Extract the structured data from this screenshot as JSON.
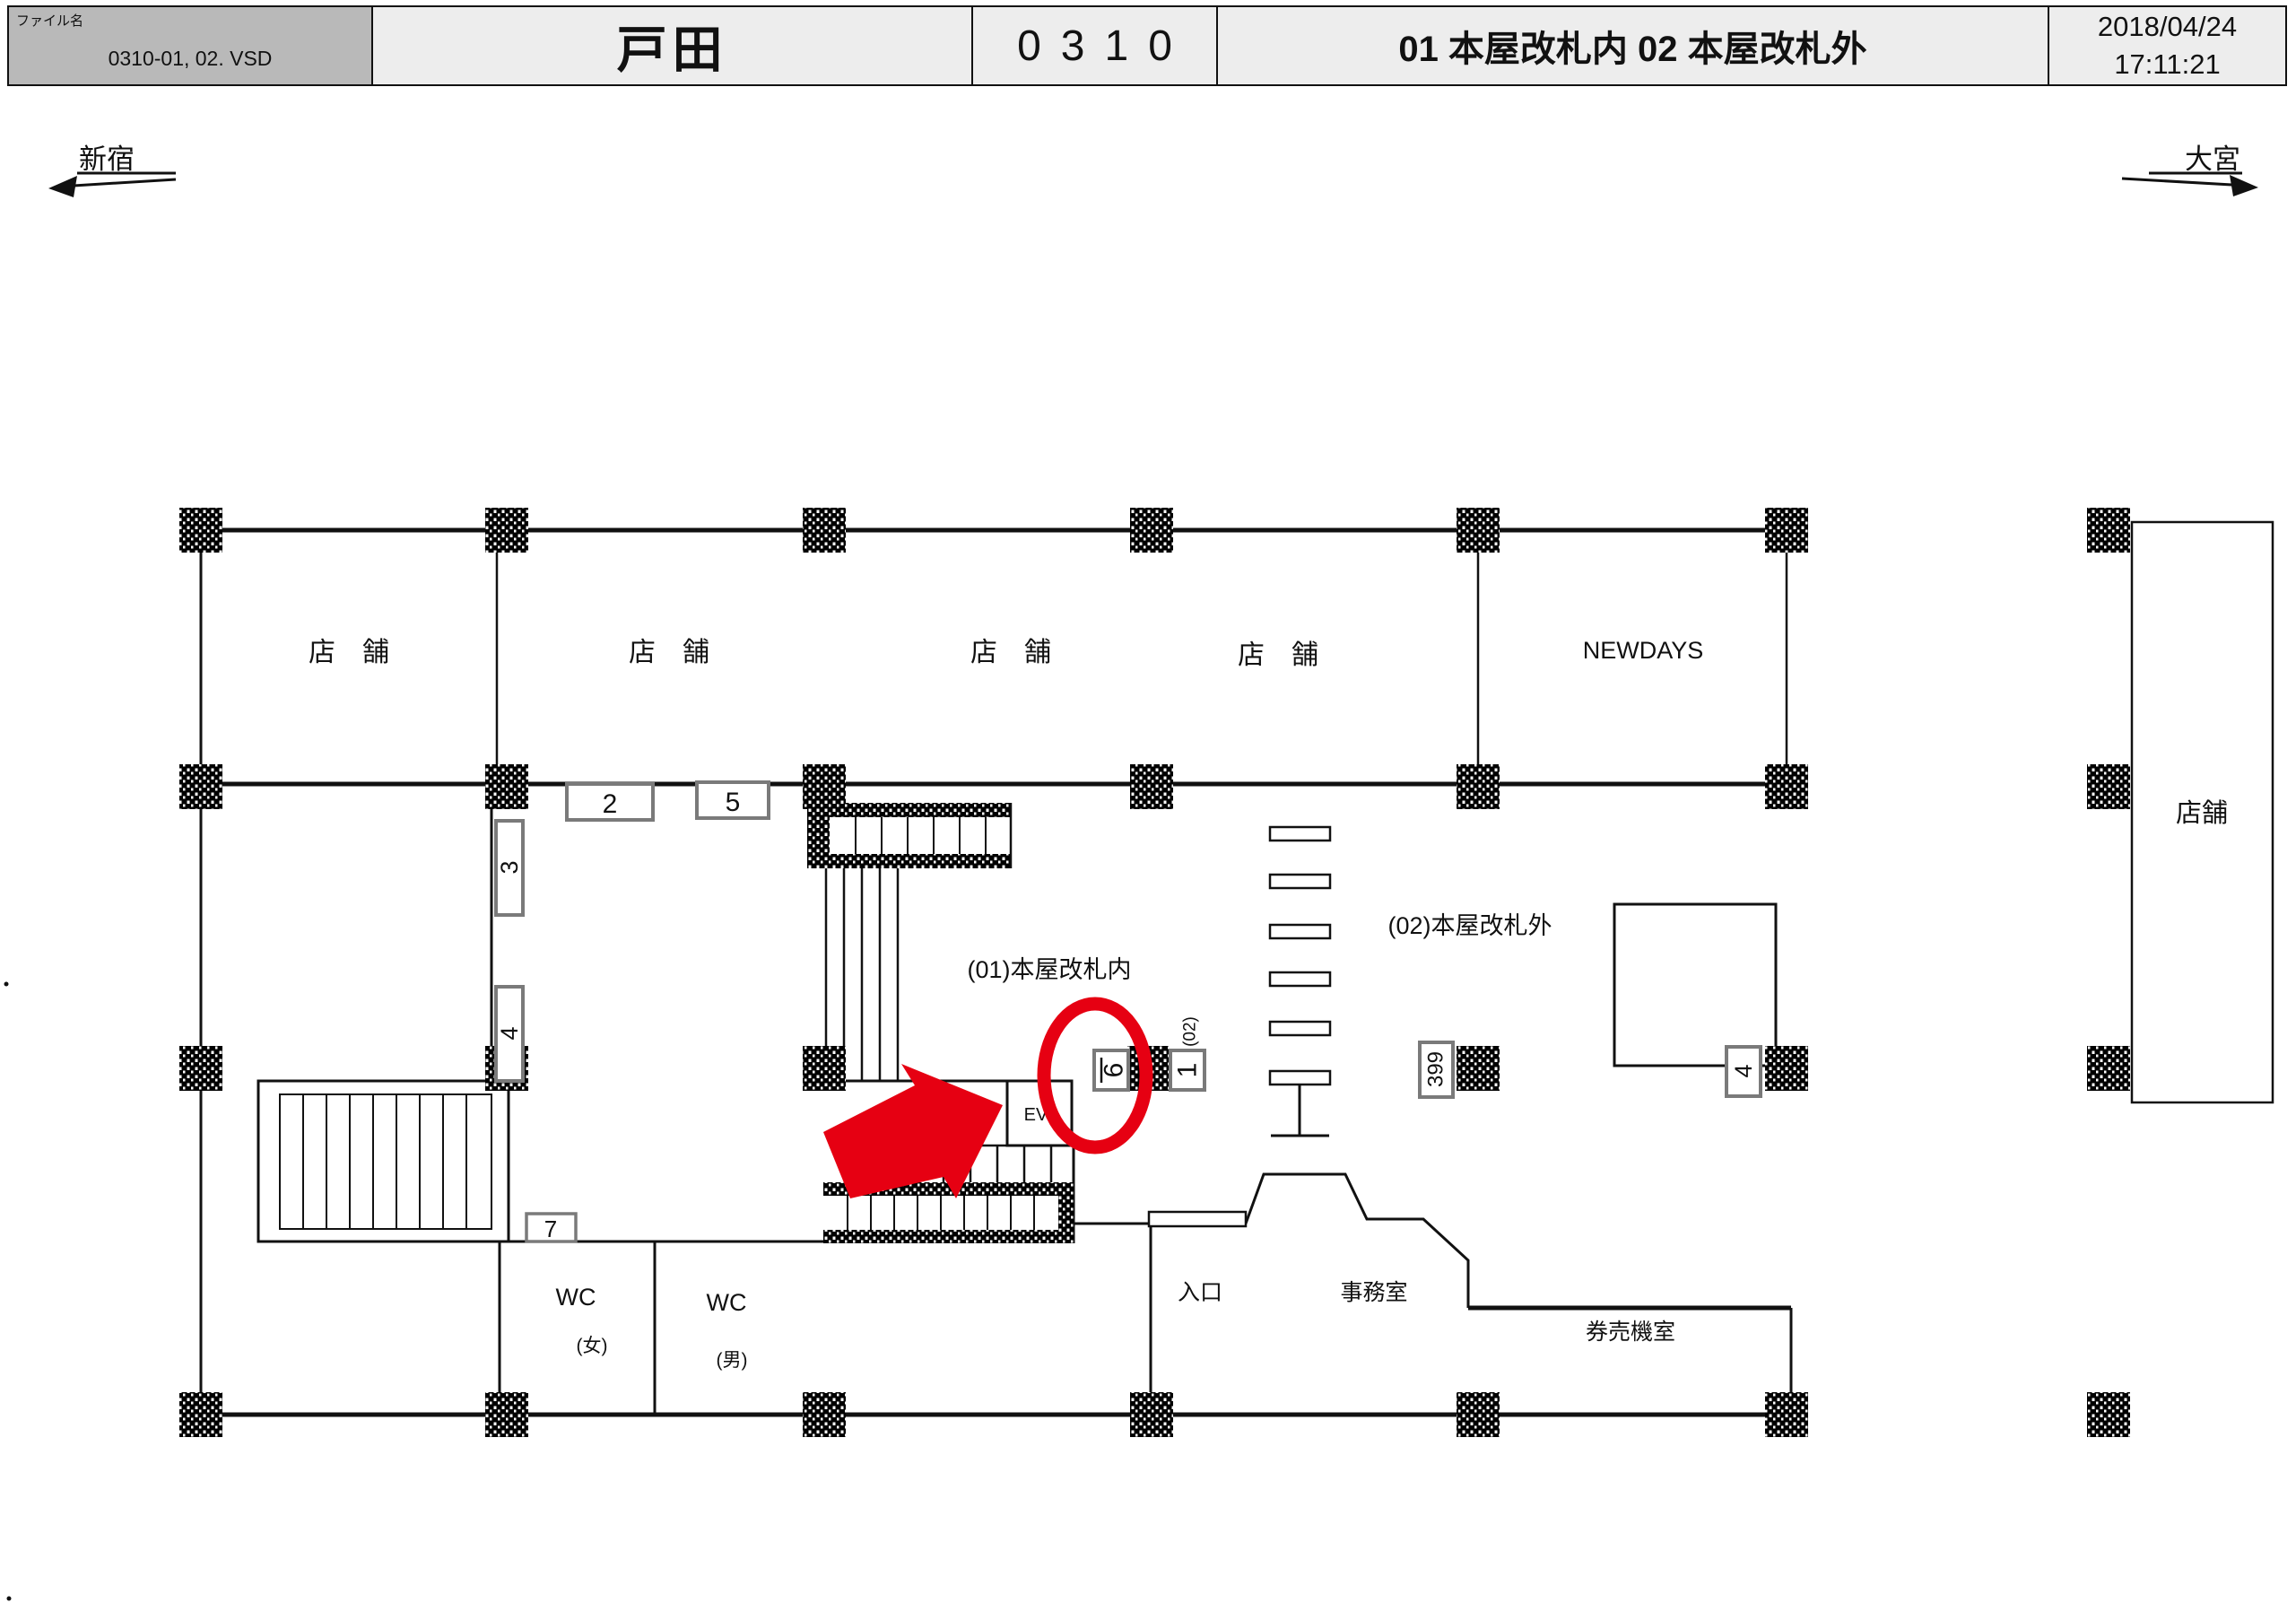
{
  "header": {
    "file_label": "ファイル名",
    "file_name": "0310-01, 02. VSD",
    "station": "戸田",
    "code": "0310",
    "sheet_title": "01 本屋改札内 02 本屋改札外",
    "date": "2018/04/24",
    "time": "17:11:21"
  },
  "nav": {
    "left": "新宿",
    "right": "大宮"
  },
  "plan": {
    "shop1": "店　舗",
    "shop2": "店　舗",
    "shop3": "店　舗",
    "shop4": "店　舗",
    "newdays": "NEWDAYS",
    "shop_right": "店舗",
    "area01": "(01)本屋改札内",
    "area02": "(02)本屋改札外",
    "wc_left": "WC",
    "wc_left_sub": "(女)",
    "wc_right": "WC",
    "wc_right_sub": "(男)",
    "entrance": "入口",
    "office": "事務室",
    "ticket_room": "券売機室",
    "elevator": "EV",
    "markers": {
      "m2": "2",
      "m5": "5",
      "m3": "3",
      "m4_left": "4",
      "m7": "7",
      "m6": "6",
      "m1": "1",
      "m399": "399",
      "m4_right": "4",
      "route02": "(02)"
    }
  },
  "colors": {
    "highlight_red": "#e60012",
    "marker_border": "#7a7a7a",
    "header_file_bg": "#b9b9b9",
    "header_cell_bg": "#ededed"
  }
}
